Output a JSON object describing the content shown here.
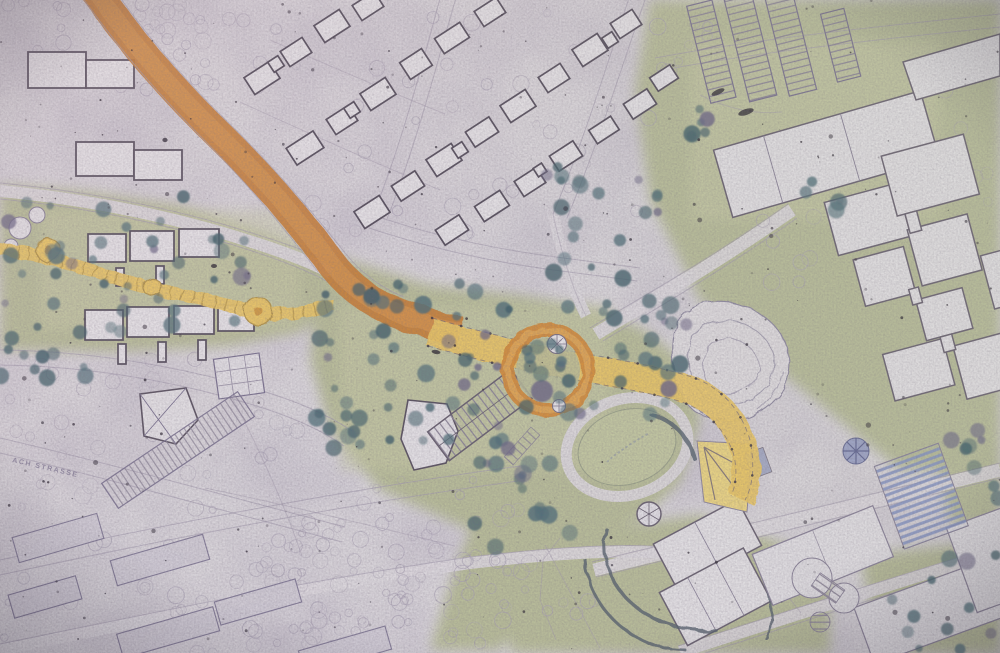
{
  "map": {
    "description": "Photograph of a hand-drawn urban master plan: highlighted orange road and yellow pedestrian route with circular ring plaza through a green park valley, housing areas, terraced housing rows and institutional building complexes",
    "street_label": "ACH STRASSE",
    "colors": {
      "paper": "#d9d5da",
      "paper_light": "#e2dfe3",
      "green": "#b8bc9a",
      "green_light": "#c9cba8",
      "route_orange": "#c67e39",
      "route_orange_light": "#d89a55",
      "route_yellow": "#e7c468",
      "route_yellow_deep": "#b3954d",
      "ring_orange": "#d28c3e",
      "lawn": "#c2c6a2",
      "terrace_yellow": "#ecd47e",
      "parking_blue": "#8392c2",
      "pinwheel_blue": "#99a0c6",
      "tree_dark": "#53707a",
      "tree_dark2": "#44616b",
      "tree_purple": "#6d6887",
      "tree_outline": "#a9a1b3",
      "building_outline": "#5d5563",
      "building_fill": "#e4e1e5",
      "line_faint": "#a49cae",
      "hatch": "#8d8698",
      "speck": "#2b2531",
      "label": "#7d7591"
    },
    "features": [
      {
        "name": "main-road",
        "kind": "orange highlighted road"
      },
      {
        "name": "pedestrian-route",
        "kind": "yellow highlighted path"
      },
      {
        "name": "ring-plaza",
        "kind": "circular orange route"
      },
      {
        "name": "boardwalk-path",
        "kind": "segmented yellow path with nodes"
      },
      {
        "name": "fountain",
        "kind": "round plaza with star"
      },
      {
        "name": "oval-lawn",
        "kind": "elliptical green"
      },
      {
        "name": "rock-mound",
        "kind": "contoured landform"
      },
      {
        "name": "stair-tower",
        "kind": "round stair"
      },
      {
        "name": "terrace-stairs",
        "kind": "yellow fan steps"
      },
      {
        "name": "parking-rows",
        "kind": "hatched parking strips"
      },
      {
        "name": "blue-parking",
        "kind": "blue hatched parking"
      },
      {
        "name": "pinwheel-canopy",
        "kind": "blue radial roof"
      },
      {
        "name": "housing-area",
        "kind": "detached houses"
      },
      {
        "name": "terraced-housing",
        "kind": "hatched row houses"
      },
      {
        "name": "institutional-complex",
        "kind": "large orthogonal blocks"
      },
      {
        "name": "orchard",
        "kind": "faint tree circles"
      },
      {
        "name": "tree-clusters",
        "kind": "dark slate trees"
      }
    ]
  }
}
